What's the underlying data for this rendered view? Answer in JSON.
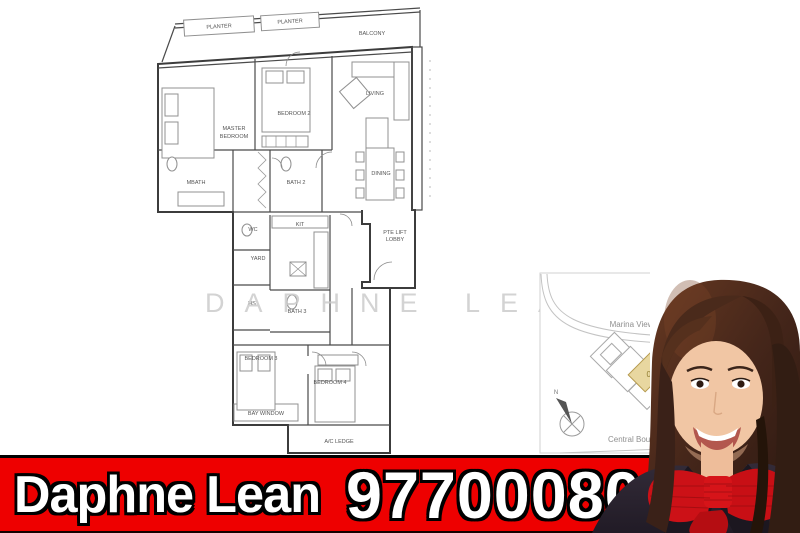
{
  "watermark": {
    "text": "DAPHNE LEAN"
  },
  "floorplan": {
    "labels": {
      "planter1": "PLANTER",
      "planter2": "PLANTER",
      "balcony": "BALCONY",
      "master_line1": "MASTER",
      "master_line2": "BEDROOM",
      "bedroom2": "BEDROOM 2",
      "living": "LIVING",
      "mbath": "MBATH",
      "bath2": "BATH 2",
      "dining": "DINING",
      "wc": "WC",
      "kit": "KIT",
      "yard": "YARD",
      "hs": "HS",
      "bath3": "BATH 3",
      "lift_line1": "PTE LIFT",
      "lift_line2": "LOBBY",
      "bedroom3": "BEDROOM 3",
      "bedroom4": "BEDROOM 4",
      "bay_window": "BAY WINDOW",
      "ac_ledge": "A/C LEDGE"
    }
  },
  "site_map": {
    "road_top": "Marina View Link",
    "road_bottom": "Central Boulevard",
    "unit_number": "02",
    "compass_north": "N",
    "unit_highlight_color": "#e8d7a0"
  },
  "banner": {
    "agent_name": "Daphne Lean",
    "phone": "97700080",
    "background_color": "#ee0000",
    "text_color": "#ffffff",
    "outline_color": "#000000"
  }
}
